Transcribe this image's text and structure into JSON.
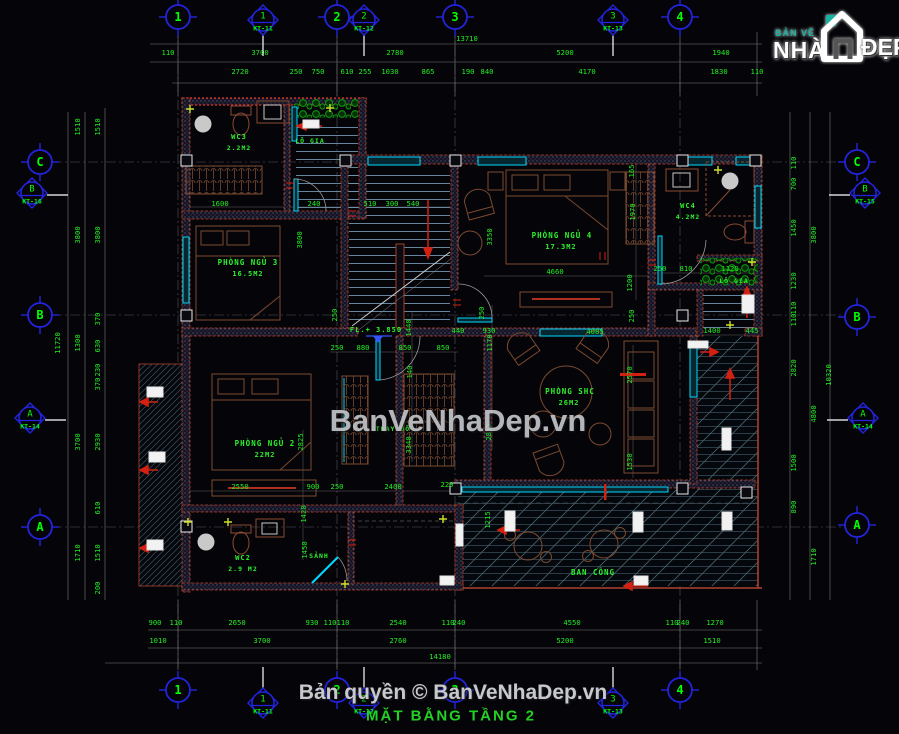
{
  "colors": {
    "background": "#050509",
    "dim_text": "#22ee22",
    "label_text": "#2df12d",
    "axis_blue": "#2323dd",
    "bubble_text": "#00ff00",
    "wall_red": "#c4452c",
    "window_cyan": "#00d9ff",
    "furniture_brown": "#7a4a30",
    "watermark_gray": "#c0c3c7",
    "title_green": "#23d123"
  },
  "logo": {
    "top": "BẢN VẼ",
    "main": "NHÀ",
    "suffix": "ĐẸP"
  },
  "watermark": {
    "text": "BanVeNhaDep.vn"
  },
  "footer": {
    "copyright": "Bản quyền © BanVeNhaDep.vn",
    "drawing_title": "MẶT BẰNG TẦNG 2"
  },
  "axes": {
    "bubbles": [
      {
        "t": "1",
        "x": 178,
        "y": 17
      },
      {
        "t": "2",
        "x": 337,
        "y": 17
      },
      {
        "t": "3",
        "x": 455,
        "y": 17
      },
      {
        "t": "4",
        "x": 680,
        "y": 17
      },
      {
        "t": "1",
        "x": 178,
        "y": 690
      },
      {
        "t": "2",
        "x": 337,
        "y": 690
      },
      {
        "t": "3",
        "x": 455,
        "y": 690
      },
      {
        "t": "4",
        "x": 680,
        "y": 690
      },
      {
        "t": "C",
        "x": 40,
        "y": 162
      },
      {
        "t": "B",
        "x": 40,
        "y": 315
      },
      {
        "t": "A",
        "x": 40,
        "y": 527
      },
      {
        "t": "C",
        "x": 857,
        "y": 162
      },
      {
        "t": "B",
        "x": 857,
        "y": 317
      },
      {
        "t": "A",
        "x": 857,
        "y": 525
      }
    ],
    "markers": [
      {
        "num": "1",
        "ref": "KT-11",
        "x": 263,
        "y": 20,
        "side": "top"
      },
      {
        "num": "2",
        "ref": "KT-12",
        "x": 364,
        "y": 20,
        "side": "top"
      },
      {
        "num": "3",
        "ref": "KT-13",
        "x": 613,
        "y": 20,
        "side": "top"
      },
      {
        "num": "B",
        "ref": "KT-16",
        "x": 32,
        "y": 193,
        "side": "left"
      },
      {
        "num": "A",
        "ref": "KT-14",
        "x": 30,
        "y": 418,
        "side": "left"
      },
      {
        "num": "B",
        "ref": "KT-15",
        "x": 865,
        "y": 193,
        "side": "right"
      },
      {
        "num": "A",
        "ref": "KT-14",
        "x": 863,
        "y": 418,
        "side": "right"
      },
      {
        "num": "1",
        "ref": "KT-11",
        "x": 263,
        "y": 703,
        "side": "bottom"
      },
      {
        "num": "2",
        "ref": "KT-12",
        "x": 364,
        "y": 703,
        "side": "bottom"
      },
      {
        "num": "3",
        "ref": "KT-13",
        "x": 613,
        "y": 703,
        "side": "bottom"
      }
    ]
  },
  "labels": [
    {
      "t": "WC3",
      "x": 239,
      "y": 137,
      "s": 7
    },
    {
      "t": "2.2M2",
      "x": 239,
      "y": 148,
      "s": 6.5
    },
    {
      "t": "LÔ GIA",
      "x": 310,
      "y": 141,
      "s": 6.5
    },
    {
      "t": "PHÒNG NGỦ 3",
      "x": 248,
      "y": 263,
      "s": 7.5
    },
    {
      "t": "16.5M2",
      "x": 248,
      "y": 274,
      "s": 7
    },
    {
      "t": "PHÒNG NGỦ 4",
      "x": 562,
      "y": 236,
      "s": 7.5
    },
    {
      "t": "17.3M2",
      "x": 561,
      "y": 247,
      "s": 7
    },
    {
      "t": "WC4",
      "x": 688,
      "y": 206,
      "s": 7
    },
    {
      "t": "4.2M2",
      "x": 688,
      "y": 217,
      "s": 6.5
    },
    {
      "t": "LÔ GIA",
      "x": 734,
      "y": 281,
      "s": 6.5
    },
    {
      "t": "PHÒNG SHC",
      "x": 570,
      "y": 392,
      "s": 7.5
    },
    {
      "t": "26M2",
      "x": 569,
      "y": 403,
      "s": 7
    },
    {
      "t": "PHÒNG NGỦ 2",
      "x": 265,
      "y": 444,
      "s": 7.5
    },
    {
      "t": "22M2",
      "x": 265,
      "y": 455,
      "s": 7
    },
    {
      "t": "THAY ĐỒ",
      "x": 393,
      "y": 429,
      "s": 6.5
    },
    {
      "t": "WC2",
      "x": 243,
      "y": 558,
      "s": 7
    },
    {
      "t": "2.9 M2",
      "x": 243,
      "y": 569,
      "s": 6.5
    },
    {
      "t": "SẢNH",
      "x": 319,
      "y": 556,
      "s": 6.5
    },
    {
      "t": "BAN CÔNG",
      "x": 593,
      "y": 573,
      "s": 7.5
    },
    {
      "t": "FL.+ 3.850",
      "x": 376,
      "y": 330,
      "s": 7
    }
  ],
  "dimensions": [
    {
      "t": "13710",
      "x": 467,
      "y": 39
    },
    {
      "t": "110",
      "x": 168,
      "y": 53
    },
    {
      "t": "3700",
      "x": 260,
      "y": 53
    },
    {
      "t": "2780",
      "x": 395,
      "y": 53
    },
    {
      "t": "5200",
      "x": 565,
      "y": 53
    },
    {
      "t": "1940",
      "x": 721,
      "y": 53
    },
    {
      "t": "2720",
      "x": 240,
      "y": 72
    },
    {
      "t": "250",
      "x": 296,
      "y": 72
    },
    {
      "t": "750",
      "x": 318,
      "y": 72
    },
    {
      "t": "610",
      "x": 347,
      "y": 72
    },
    {
      "t": "255",
      "x": 365,
      "y": 72
    },
    {
      "t": "1030",
      "x": 390,
      "y": 72
    },
    {
      "t": "865",
      "x": 428,
      "y": 72
    },
    {
      "t": "190",
      "x": 468,
      "y": 72
    },
    {
      "t": "840",
      "x": 487,
      "y": 72
    },
    {
      "t": "4170",
      "x": 587,
      "y": 72
    },
    {
      "t": "1830",
      "x": 719,
      "y": 72
    },
    {
      "t": "110",
      "x": 757,
      "y": 72
    },
    {
      "t": "900",
      "x": 155,
      "y": 623
    },
    {
      "t": "110",
      "x": 176,
      "y": 623
    },
    {
      "t": "2650",
      "x": 237,
      "y": 623
    },
    {
      "t": "930",
      "x": 312,
      "y": 623
    },
    {
      "t": "110",
      "x": 330,
      "y": 623
    },
    {
      "t": "110",
      "x": 343,
      "y": 623
    },
    {
      "t": "2540",
      "x": 398,
      "y": 623
    },
    {
      "t": "110",
      "x": 448,
      "y": 623
    },
    {
      "t": "240",
      "x": 459,
      "y": 623
    },
    {
      "t": "4550",
      "x": 572,
      "y": 623
    },
    {
      "t": "110",
      "x": 672,
      "y": 623
    },
    {
      "t": "240",
      "x": 683,
      "y": 623
    },
    {
      "t": "1270",
      "x": 715,
      "y": 623
    },
    {
      "t": "1010",
      "x": 158,
      "y": 641
    },
    {
      "t": "3700",
      "x": 262,
      "y": 641
    },
    {
      "t": "2760",
      "x": 398,
      "y": 641
    },
    {
      "t": "5200",
      "x": 565,
      "y": 641
    },
    {
      "t": "1510",
      "x": 712,
      "y": 641
    },
    {
      "t": "14180",
      "x": 440,
      "y": 657
    },
    {
      "t": "11720",
      "x": 58,
      "y": 343,
      "r": 1
    },
    {
      "t": "1510",
      "x": 78,
      "y": 127,
      "r": 1
    },
    {
      "t": "3800",
      "x": 78,
      "y": 235,
      "r": 1
    },
    {
      "t": "1300",
      "x": 78,
      "y": 343,
      "r": 1
    },
    {
      "t": "3700",
      "x": 78,
      "y": 442,
      "r": 1
    },
    {
      "t": "1710",
      "x": 78,
      "y": 553,
      "r": 1
    },
    {
      "t": "1510",
      "x": 98,
      "y": 127,
      "r": 1
    },
    {
      "t": "3800",
      "x": 98,
      "y": 235,
      "r": 1
    },
    {
      "t": "370",
      "x": 98,
      "y": 319,
      "r": 1
    },
    {
      "t": "630",
      "x": 98,
      "y": 346,
      "r": 1
    },
    {
      "t": "230",
      "x": 98,
      "y": 370,
      "r": 1
    },
    {
      "t": "370",
      "x": 98,
      "y": 384,
      "r": 1
    },
    {
      "t": "2930",
      "x": 98,
      "y": 442,
      "r": 1
    },
    {
      "t": "610",
      "x": 98,
      "y": 508,
      "r": 1
    },
    {
      "t": "1510",
      "x": 98,
      "y": 553,
      "r": 1
    },
    {
      "t": "200",
      "x": 98,
      "y": 588,
      "r": 1
    },
    {
      "t": "110",
      "x": 794,
      "y": 163,
      "r": 1
    },
    {
      "t": "700",
      "x": 794,
      "y": 184,
      "r": 1
    },
    {
      "t": "1450",
      "x": 794,
      "y": 228,
      "r": 1
    },
    {
      "t": "1230",
      "x": 794,
      "y": 281,
      "r": 1
    },
    {
      "t": "110",
      "x": 794,
      "y": 308,
      "r": 1
    },
    {
      "t": "110",
      "x": 794,
      "y": 320,
      "r": 1
    },
    {
      "t": "2820",
      "x": 794,
      "y": 368,
      "r": 1
    },
    {
      "t": "1500",
      "x": 794,
      "y": 463,
      "r": 1
    },
    {
      "t": "890",
      "x": 794,
      "y": 507,
      "r": 1
    },
    {
      "t": "3800",
      "x": 814,
      "y": 235,
      "r": 1
    },
    {
      "t": "4800",
      "x": 814,
      "y": 414,
      "r": 1
    },
    {
      "t": "1710",
      "x": 814,
      "y": 557,
      "r": 1
    },
    {
      "t": "10320",
      "x": 829,
      "y": 375,
      "r": 1
    },
    {
      "t": "1600",
      "x": 220,
      "y": 204
    },
    {
      "t": "240",
      "x": 314,
      "y": 204
    },
    {
      "t": "510",
      "x": 370,
      "y": 204
    },
    {
      "t": "300",
      "x": 392,
      "y": 204
    },
    {
      "t": "540",
      "x": 413,
      "y": 204
    },
    {
      "t": "3800",
      "x": 300,
      "y": 240,
      "r": 1
    },
    {
      "t": "3350",
      "x": 490,
      "y": 237,
      "r": 1
    },
    {
      "t": "4660",
      "x": 555,
      "y": 272
    },
    {
      "t": "1970",
      "x": 633,
      "y": 212,
      "r": 1
    },
    {
      "t": "165",
      "x": 632,
      "y": 171,
      "r": 1
    },
    {
      "t": "1200",
      "x": 630,
      "y": 283,
      "r": 1
    },
    {
      "t": "250",
      "x": 660,
      "y": 269
    },
    {
      "t": "810",
      "x": 686,
      "y": 269
    },
    {
      "t": "1120",
      "x": 730,
      "y": 269
    },
    {
      "t": "250",
      "x": 335,
      "y": 315,
      "r": 1
    },
    {
      "t": "1440",
      "x": 409,
      "y": 328,
      "r": 1
    },
    {
      "t": "140",
      "x": 410,
      "y": 372,
      "r": 1
    },
    {
      "t": "3340",
      "x": 409,
      "y": 445,
      "r": 1
    },
    {
      "t": "250",
      "x": 337,
      "y": 348
    },
    {
      "t": "880",
      "x": 363,
      "y": 348
    },
    {
      "t": "850",
      "x": 405,
      "y": 348
    },
    {
      "t": "850",
      "x": 443,
      "y": 348
    },
    {
      "t": "440",
      "x": 458,
      "y": 331
    },
    {
      "t": "930",
      "x": 489,
      "y": 331
    },
    {
      "t": "250",
      "x": 482,
      "y": 313,
      "r": 1
    },
    {
      "t": "1170",
      "x": 490,
      "y": 343,
      "r": 1
    },
    {
      "t": "2815",
      "x": 489,
      "y": 432,
      "r": 1
    },
    {
      "t": "4085",
      "x": 595,
      "y": 332
    },
    {
      "t": "250",
      "x": 632,
      "y": 316,
      "r": 1
    },
    {
      "t": "2570",
      "x": 630,
      "y": 375,
      "r": 1
    },
    {
      "t": "1530",
      "x": 630,
      "y": 462,
      "r": 1
    },
    {
      "t": "1400",
      "x": 712,
      "y": 331
    },
    {
      "t": "445",
      "x": 752,
      "y": 331
    },
    {
      "t": "2550",
      "x": 240,
      "y": 487
    },
    {
      "t": "900",
      "x": 313,
      "y": 487
    },
    {
      "t": "250",
      "x": 337,
      "y": 487
    },
    {
      "t": "2400",
      "x": 393,
      "y": 487
    },
    {
      "t": "2825",
      "x": 301,
      "y": 442,
      "r": 1
    },
    {
      "t": "1420",
      "x": 304,
      "y": 514,
      "r": 1
    },
    {
      "t": "1450",
      "x": 305,
      "y": 550,
      "r": 1
    },
    {
      "t": "220",
      "x": 447,
      "y": 485
    },
    {
      "t": "1215",
      "x": 488,
      "y": 520,
      "r": 1
    }
  ]
}
